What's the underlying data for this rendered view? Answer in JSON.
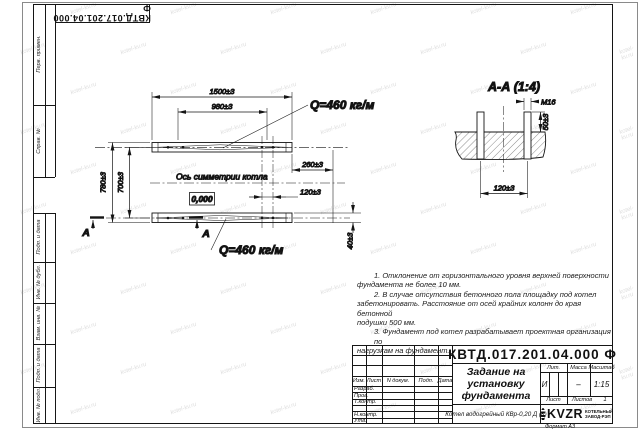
{
  "sheet": {
    "format_note": "Формат А3",
    "watermark_text": "kotel-kv.ru"
  },
  "margins": {
    "flip_doc_number": "КВТД.017.201.04.000 Ф",
    "stamp_perv": "Перв. примен.",
    "stamp_sprav": "Справ. №",
    "stamp_podp1": "Подп. и дата",
    "stamp_inv_dubl": "Инв. № дубл.",
    "stamp_vzam": "Взам. инв. №",
    "stamp_podp2": "Подп. и дата",
    "stamp_inv_podl": "Инв. № подл."
  },
  "plan": {
    "dim_overall": "1500±3",
    "dim_bolt_groups": "980±3",
    "dim_outer_height": "780±3",
    "dim_inner_height": "700±3",
    "dim_right_offset": "260±3",
    "dim_bolt_pitch": "120±3",
    "dim_beam_width": "40±3",
    "load_top": "Q=460 кг/м",
    "load_bottom": "Q=460 кг/м",
    "axis_label": "Ось симметрии котла",
    "level_mark": "0,000",
    "section_letter_left": "А",
    "section_letter_right": "А"
  },
  "section": {
    "title": "А-А (1:4)",
    "thread": "М16",
    "dim_protrusion": "50±3",
    "dim_pitch": "120±3"
  },
  "notes": {
    "lines": [
      "1. Отклонение от горизонтального уровня верхней поверхности",
      "фундамента не более 10 мм.",
      "2. В случае отсутствия бетонного пола площадку под котел",
      "забетонировать. Расстояние от осей крайних колонн до края бетонной",
      "подушки 500 мм.",
      "3. Фундамент под котел разрабатывает проектная организация по",
      "нагрузкам на фундамент."
    ]
  },
  "title_block": {
    "doc_number": "КВТД.017.201.04.000 Ф",
    "title_line1": "Задание на",
    "title_line2": "установку",
    "title_line3": "фундамента",
    "product": "Котел водогрейный КВр-0,20 Д (К)",
    "col_izm": "Изм.",
    "col_list": "Лист",
    "col_docum": "N докум.",
    "col_podp": "Подп.",
    "col_data": "Дата",
    "row_razrab": "Разраб.",
    "row_prov": "Пров.",
    "row_tkontr": "Т.контр.",
    "row_nkontr": "Н.контр.",
    "row_utv": "Утв.",
    "lit_label": "Лит.",
    "lit_value": "И",
    "mass_label": "Масса",
    "mass_value": "–",
    "scale_label": "Масштаб",
    "scale_value": "1:15",
    "sheet_label": "Лист",
    "sheets_label": "Листов",
    "sheets_value": "1",
    "logo_text": "KVZR",
    "company_line1": "КОТЕЛЬНЫЙ",
    "company_line2": "ЗАВОД-РЭП"
  }
}
